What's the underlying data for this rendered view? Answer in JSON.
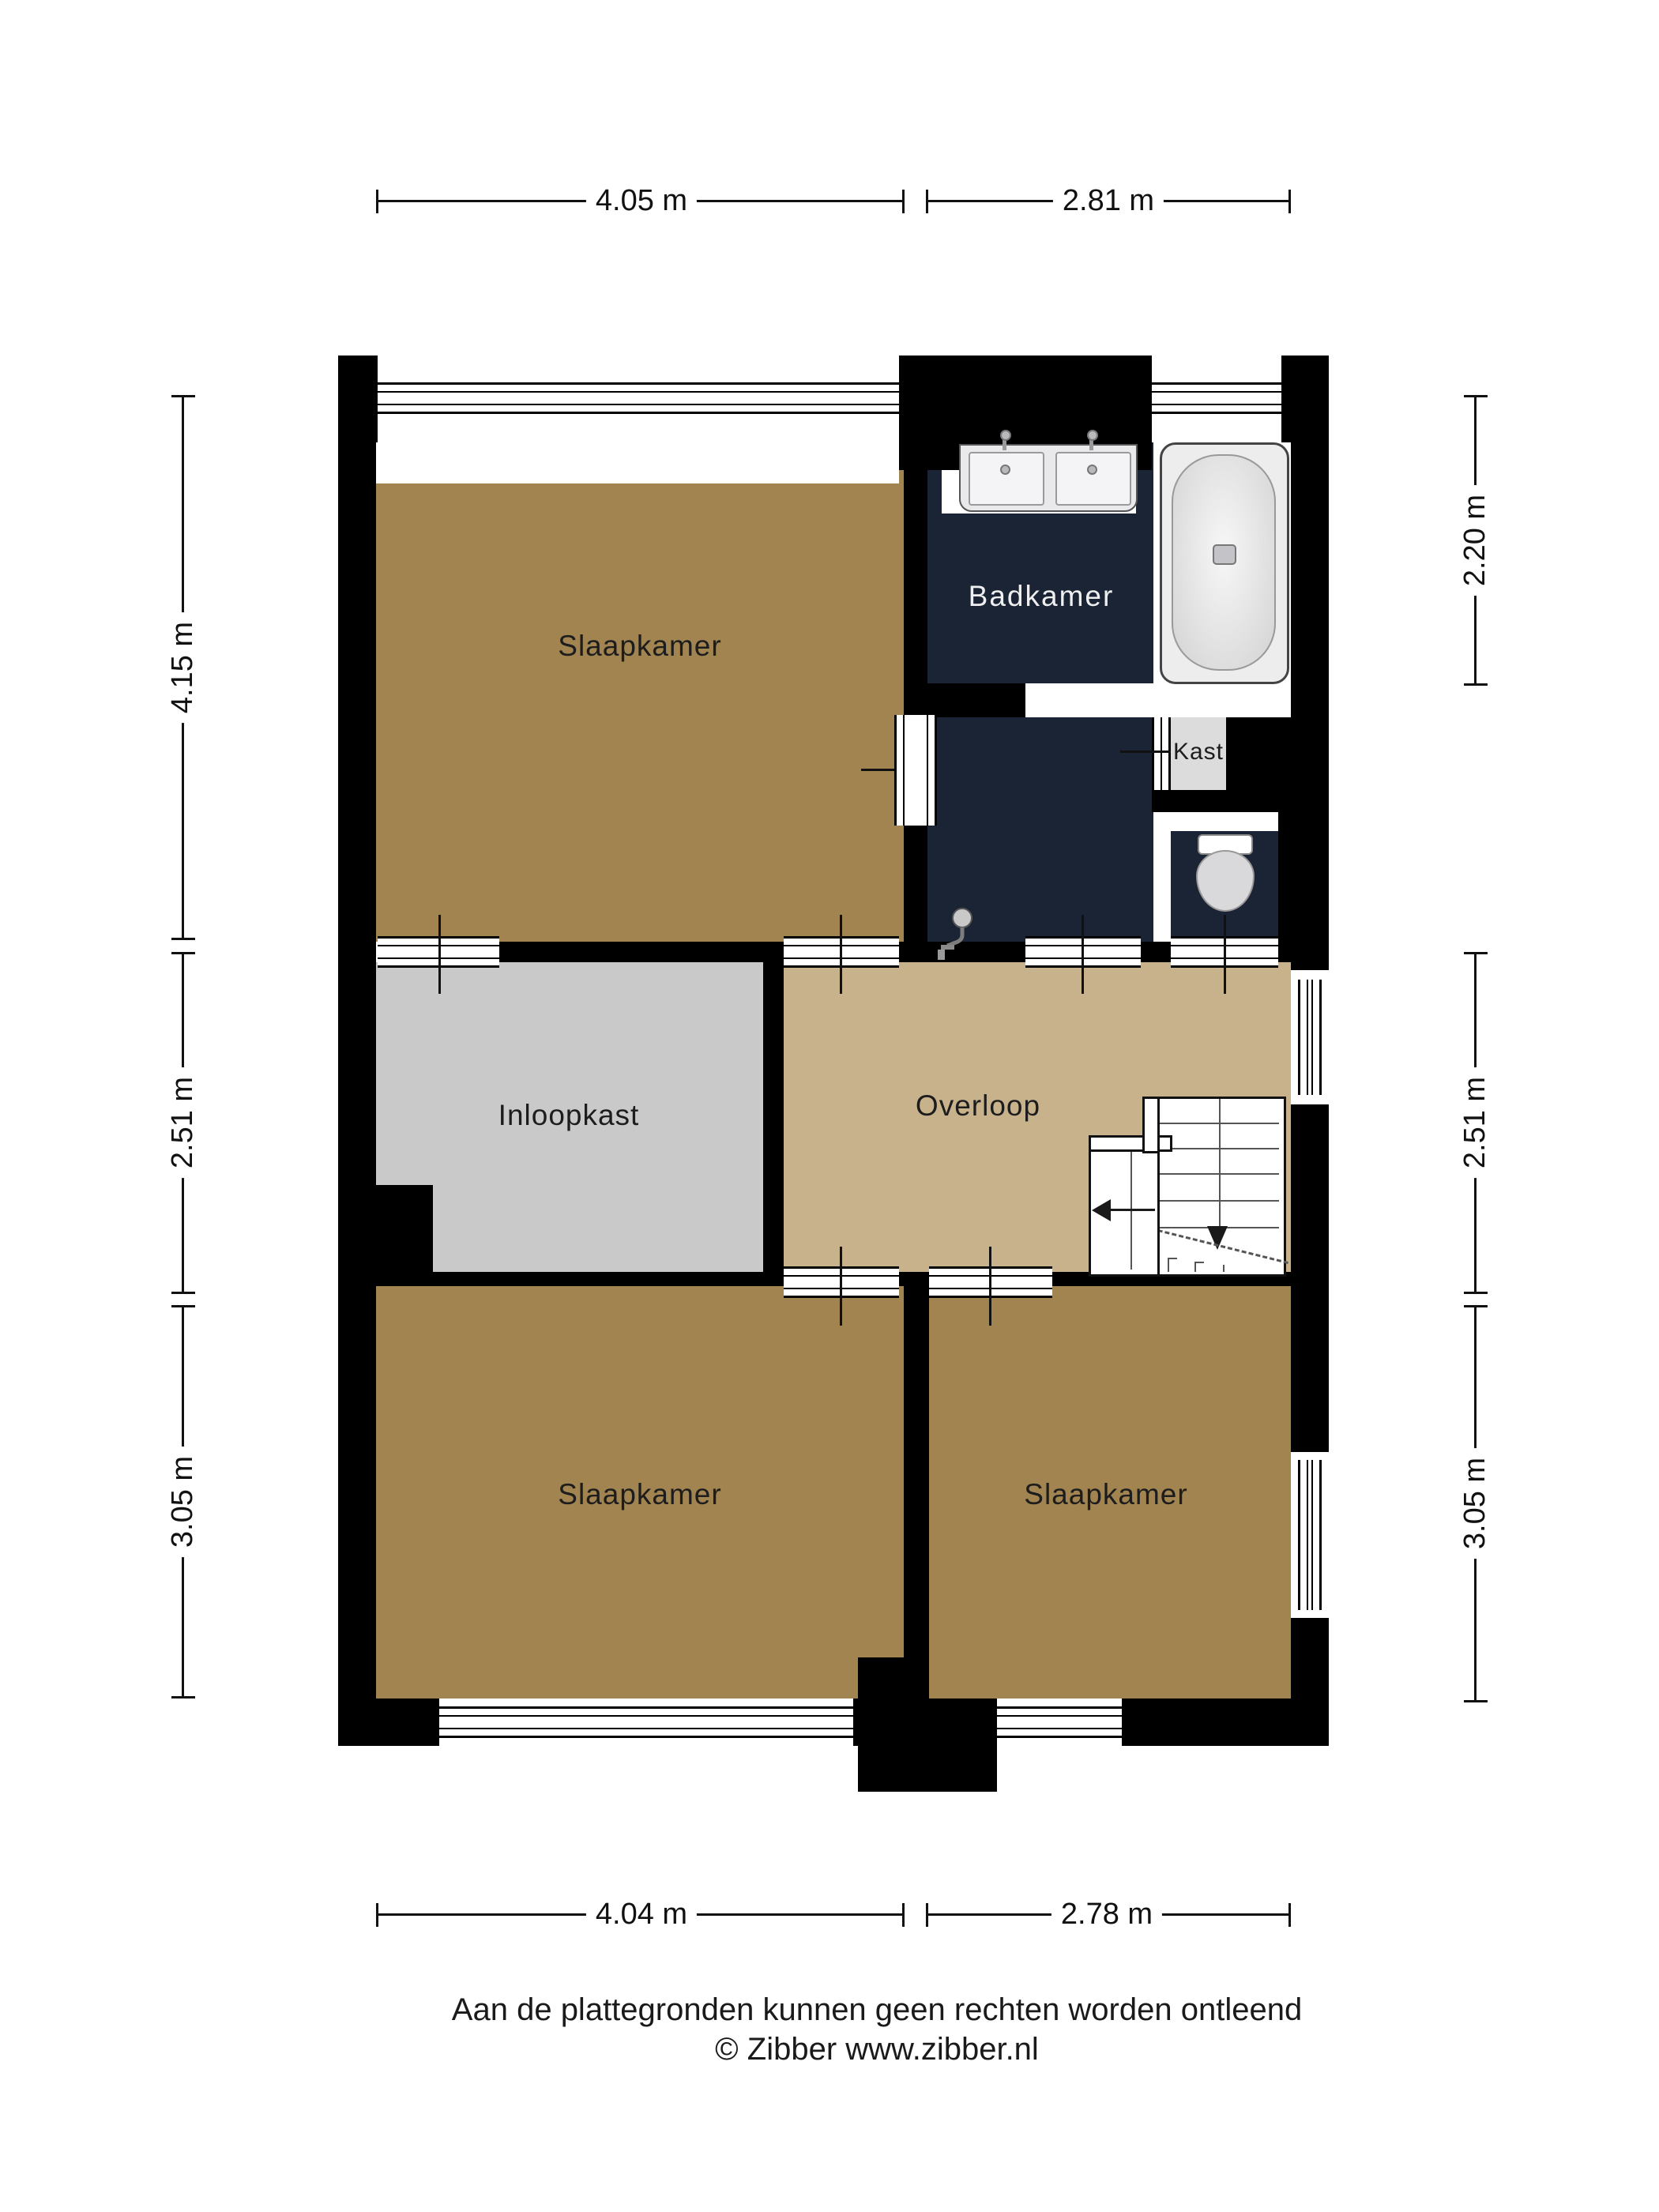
{
  "footer": {
    "line1": "Aan de plattegronden kunnen geen rechten worden ontleend",
    "line2": "© Zibber www.zibber.nl"
  },
  "rooms": {
    "bedroom_top_left": {
      "label": "Slaapkamer"
    },
    "bathroom": {
      "label": "Badkamer"
    },
    "closet": {
      "label": "Kast"
    },
    "walk_in_closet": {
      "label": "Inloopkast"
    },
    "landing": {
      "label": "Overloop"
    },
    "bedroom_bottom_left": {
      "label": "Slaapkamer"
    },
    "bedroom_bottom_right": {
      "label": "Slaapkamer"
    }
  },
  "dimensions": {
    "top": [
      {
        "label": "4.05 m"
      },
      {
        "label": "2.81 m"
      }
    ],
    "bottom": [
      {
        "label": "4.04 m"
      },
      {
        "label": "2.78 m"
      }
    ],
    "left": [
      {
        "label": "4.15 m"
      },
      {
        "label": "2.51 m"
      },
      {
        "label": "3.05 m"
      }
    ],
    "right": [
      {
        "label": "2.20 m"
      },
      {
        "label": "2.51 m"
      },
      {
        "label": "3.05 m"
      }
    ]
  },
  "fixtures": {
    "bathtub": "bathtub",
    "double_sink": "double-sink",
    "toilet": "toilet",
    "shower": "shower-head",
    "staircase": "staircase-down"
  },
  "colors": {
    "wall": "#000000",
    "bedroom_floor": "#A28450",
    "landing_floor": "#C8B28C",
    "walk_in_closet_floor": "#C9C9C9",
    "closet_floor": "#DCDCDC",
    "bathroom_floor": "#1B2434",
    "fixture_light": "#E9E9EC",
    "paper": "#FFFFFF"
  }
}
